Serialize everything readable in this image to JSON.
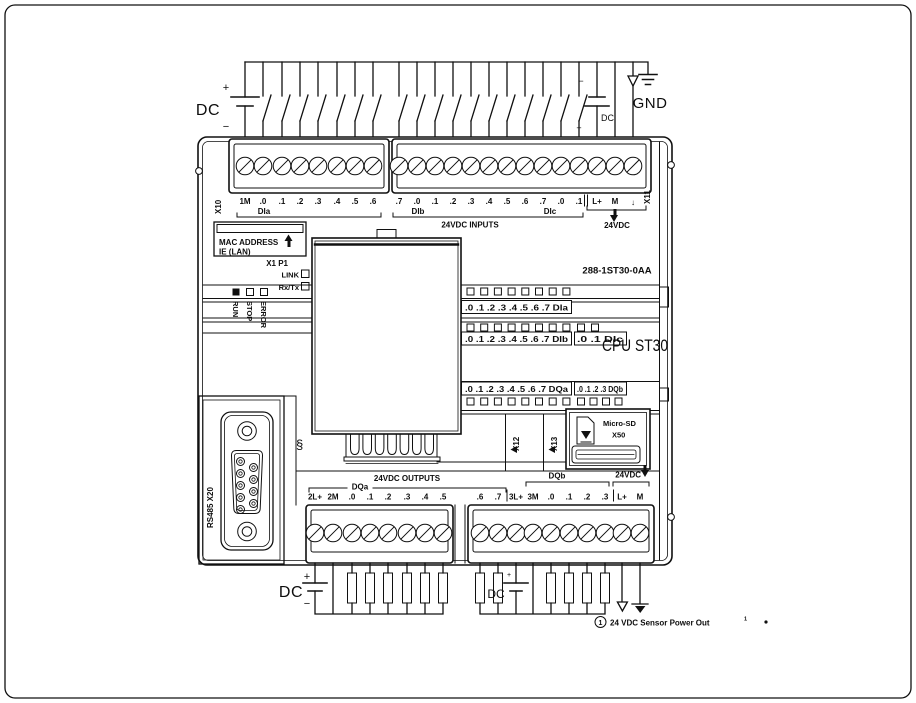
{
  "symbols": {
    "plus": "+",
    "minus": "−",
    "dc": "DC",
    "gnd": "GND",
    "clamp": "§"
  },
  "top_terminals": {
    "x10": "X10",
    "x11": "X11",
    "block_a": [
      "1M",
      ".0",
      ".1",
      ".2",
      ".3",
      ".4",
      ".5",
      ".6"
    ],
    "group_a": "DIa",
    "block_b": [
      ".7",
      ".0",
      ".1",
      ".2",
      ".3",
      ".4",
      ".5",
      ".6",
      ".7",
      ".0",
      ".1"
    ],
    "group_b": "DIb",
    "group_c": "DIc",
    "power": [
      "L+",
      "M",
      "↓"
    ],
    "inputs_caption": "24VDC INPUTS",
    "power_caption": "24VDC"
  },
  "front_panel": {
    "mac_label": "MAC ADDRESS",
    "mac_sub": "IE (LAN)",
    "port_label": "X1 P1",
    "link_label": "LINK",
    "rxtx_label": "Rx/Tx",
    "status_leds": [
      "RUN",
      "STOP",
      "ERROR"
    ],
    "order_no": "288-1ST30-0AA",
    "cpu_label": "CPU ST30",
    "led_rows": {
      "dia": ".0 .1 .2 .3 .4 .5 .6 .7  DIa",
      "dib": ".0 .1 .2 .3 .4 .5 .6 .7  DIb",
      "dic": ".0 .1  DIc",
      "dqa": ".0 .1 .2 .3 .4 .5 .6 .7  DQa",
      "dqb": ".0 .1 .2 .3  DQb"
    },
    "x12": "X12",
    "x13": "X13",
    "sd_label": "Micro-SD",
    "sd_port": "X50",
    "rs485_label": "RS485  X20"
  },
  "bottom_terminals": {
    "outputs_caption": "24VDC OUTPUTS",
    "dqa_caption": "DQa",
    "dqb_caption": "DQb",
    "power_caption": "24VDC",
    "block_a": [
      "2L+",
      "2M",
      ".0",
      ".1",
      ".2",
      ".3",
      ".4",
      ".5"
    ],
    "block_b": [
      ".6",
      ".7",
      "3L+",
      "3M",
      ".0",
      ".1",
      ".2",
      ".3",
      "L+",
      "M"
    ]
  },
  "footnote": {
    "ref": "1",
    "text": "24 VDC Sensor Power Out",
    "sup": "1"
  }
}
